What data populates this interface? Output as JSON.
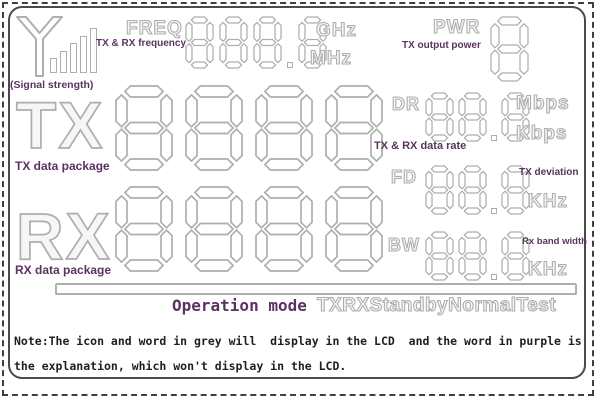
{
  "colors": {
    "lcd_grey": "#aeaeae",
    "label_purple": "#5a3360",
    "note_text": "#1f1f1f",
    "border_dark": "#4a4a4a",
    "background": "#ffffff"
  },
  "lcd": {
    "signal": {
      "icon": "antenna-icon",
      "bars": 5,
      "label": "(Signal strength)"
    },
    "freq": {
      "name": "FREQ",
      "explanation": "TX & RX frequency",
      "digits": "888.8",
      "unit_top": "GHz",
      "unit_bottom": "MHz"
    },
    "pwr": {
      "name": "PWR",
      "explanation": "TX output power",
      "digits": "8"
    },
    "tx": {
      "name": "TX",
      "explanation": "TX data package",
      "digits": "8888"
    },
    "dr": {
      "name": "DR",
      "explanation": "TX & RX data rate",
      "digits": "88.8",
      "unit_top": "Mbps",
      "unit_bottom": "Kbps"
    },
    "fd": {
      "name": "FD",
      "explanation": "TX deviation",
      "digits": "88.8",
      "unit": "KHz"
    },
    "rx": {
      "name": "RX",
      "explanation": "RX data package",
      "digits": "8888"
    },
    "bw": {
      "name": "BW",
      "explanation": "Rx band width",
      "digits": "88.8",
      "unit": "KHz"
    },
    "operation": {
      "explanation": "Operation mode",
      "modes": "TXRXStandbyNormalTest"
    }
  },
  "note": {
    "line1": "Note:The icon and word in grey will  display in the LCD  and the word in purple is",
    "line2": "the explanation, which won't display in the LCD."
  }
}
